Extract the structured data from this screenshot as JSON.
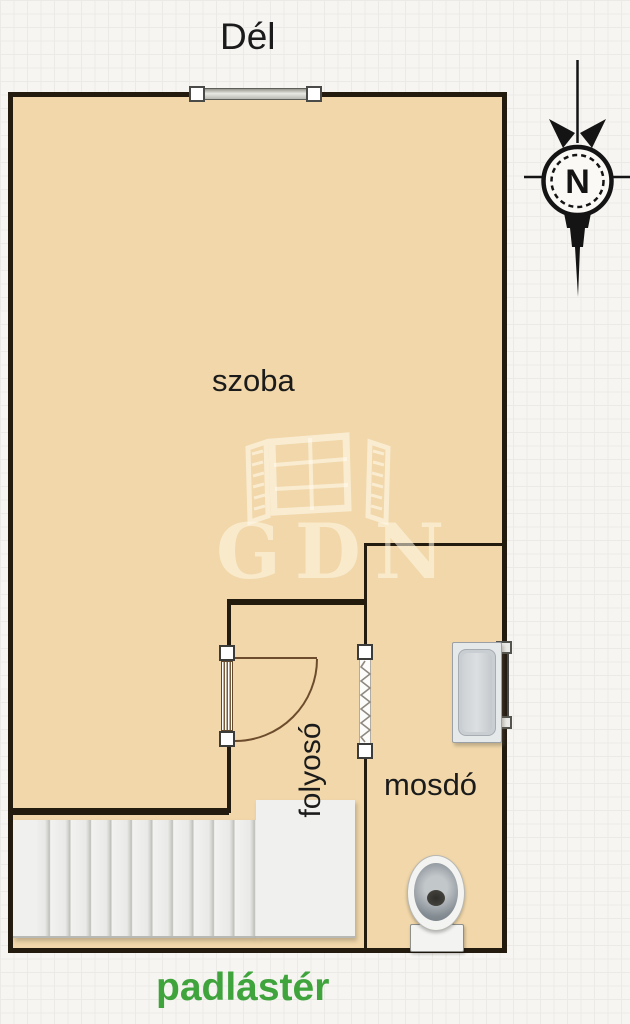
{
  "labels": {
    "orientation": "Dél",
    "room": "szoba",
    "corridor": "folyosó",
    "washroom": "mosdó",
    "attic": "padlástér"
  },
  "compass": {
    "letter": "N"
  },
  "watermark": {
    "text": "GDN"
  },
  "colors": {
    "room_fill": "#f1d7a9",
    "wall": "#241b0f",
    "attic_label_green": "#3fa43c",
    "background": "#f6f5f2",
    "grid_line": "#e1ded8",
    "door_swing_brown": "#6d4c2d",
    "stair_fill": "#f0f0ee",
    "fixture_gray": "#c9ced2"
  },
  "icons": {
    "compass": "compass-north-icon",
    "top_window": "window-icon",
    "bath_window": "window-icon",
    "entry_door": "door-swing-icon",
    "folding_door": "folding-door-icon",
    "stairs": "stairs-icon",
    "bathtub": "bathtub-icon",
    "toilet": "toilet-icon",
    "watermark_logo": "window-logo-icon"
  }
}
